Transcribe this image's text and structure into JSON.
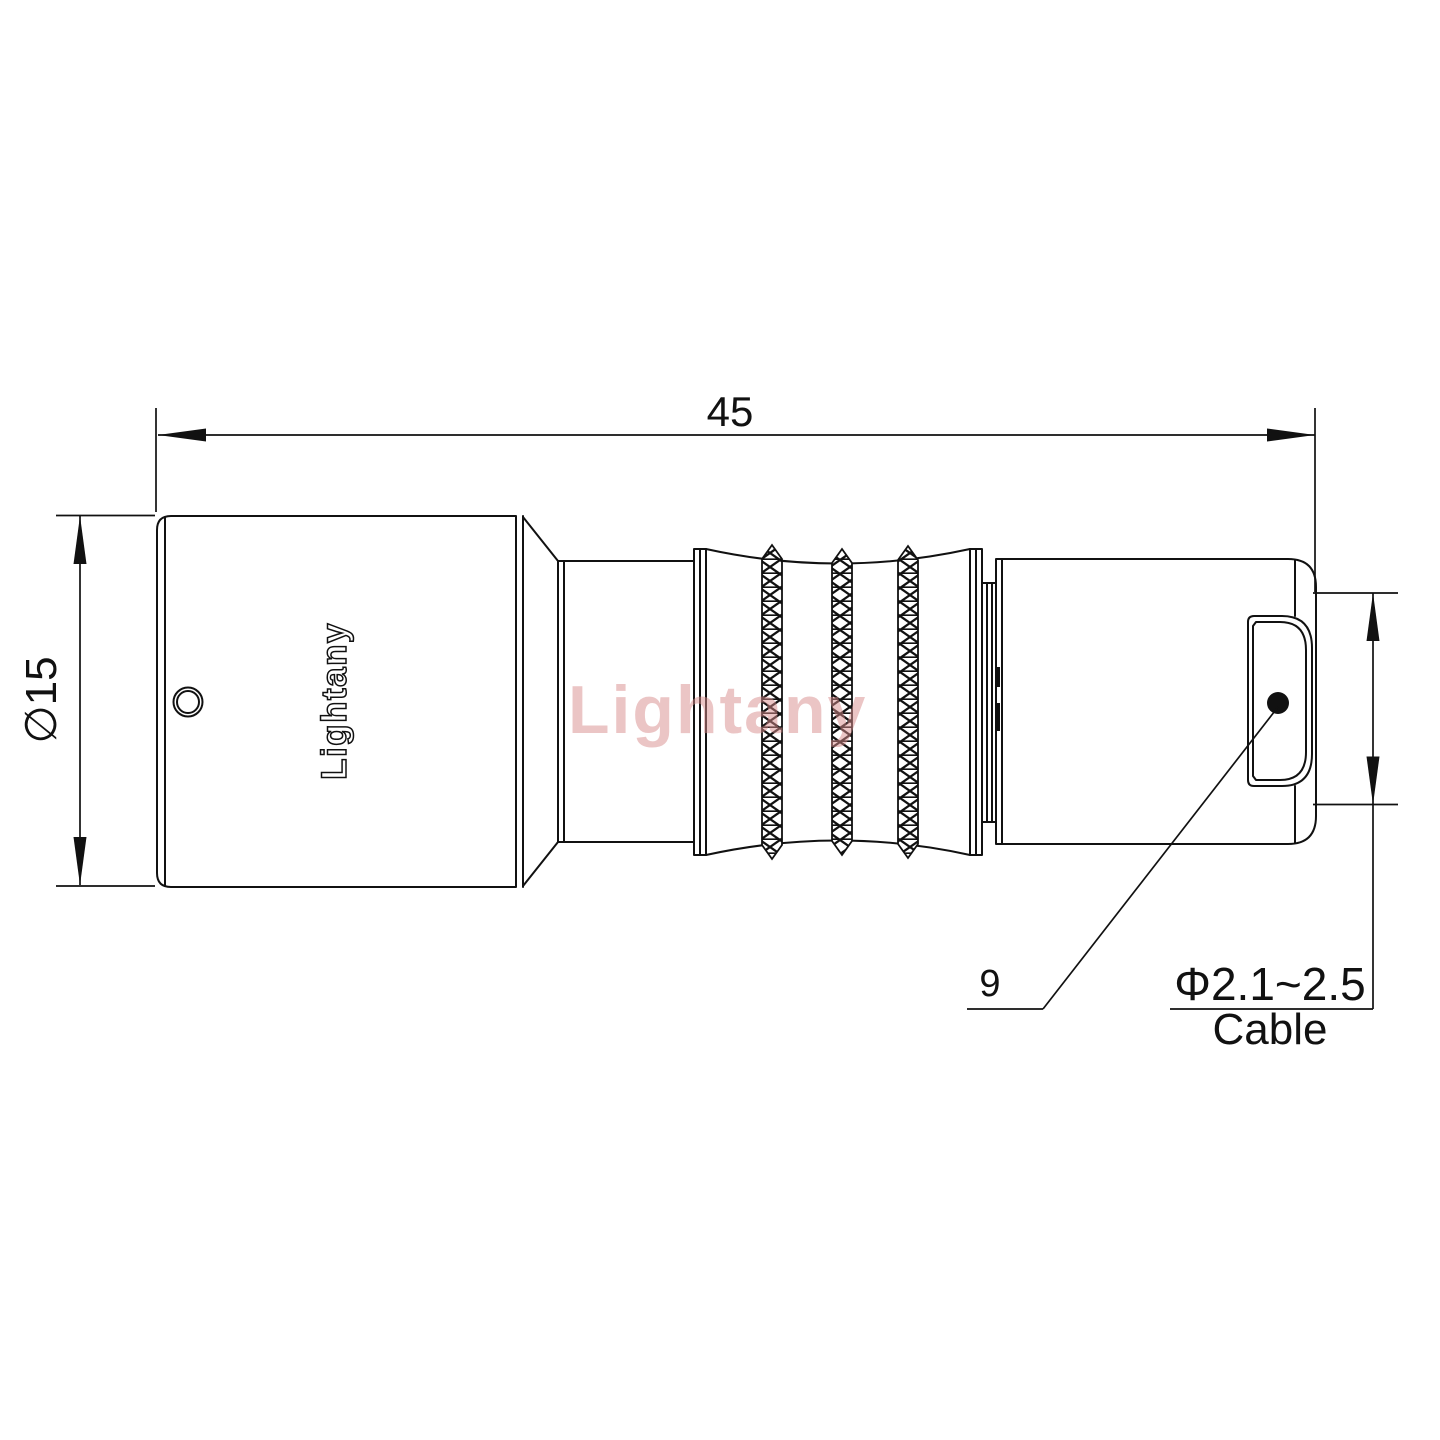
{
  "dims": {
    "length": "45",
    "diameter": "∅15"
  },
  "callout": {
    "shell": "9"
  },
  "cable": {
    "range": "Φ2.1~2.5",
    "label": "Cable"
  },
  "branding": {
    "engraving": "Lightany",
    "watermark": "Lightany"
  },
  "colors": {
    "line": "#111111",
    "watermark_pink": "#d98c8c",
    "background": "#ffffff"
  }
}
